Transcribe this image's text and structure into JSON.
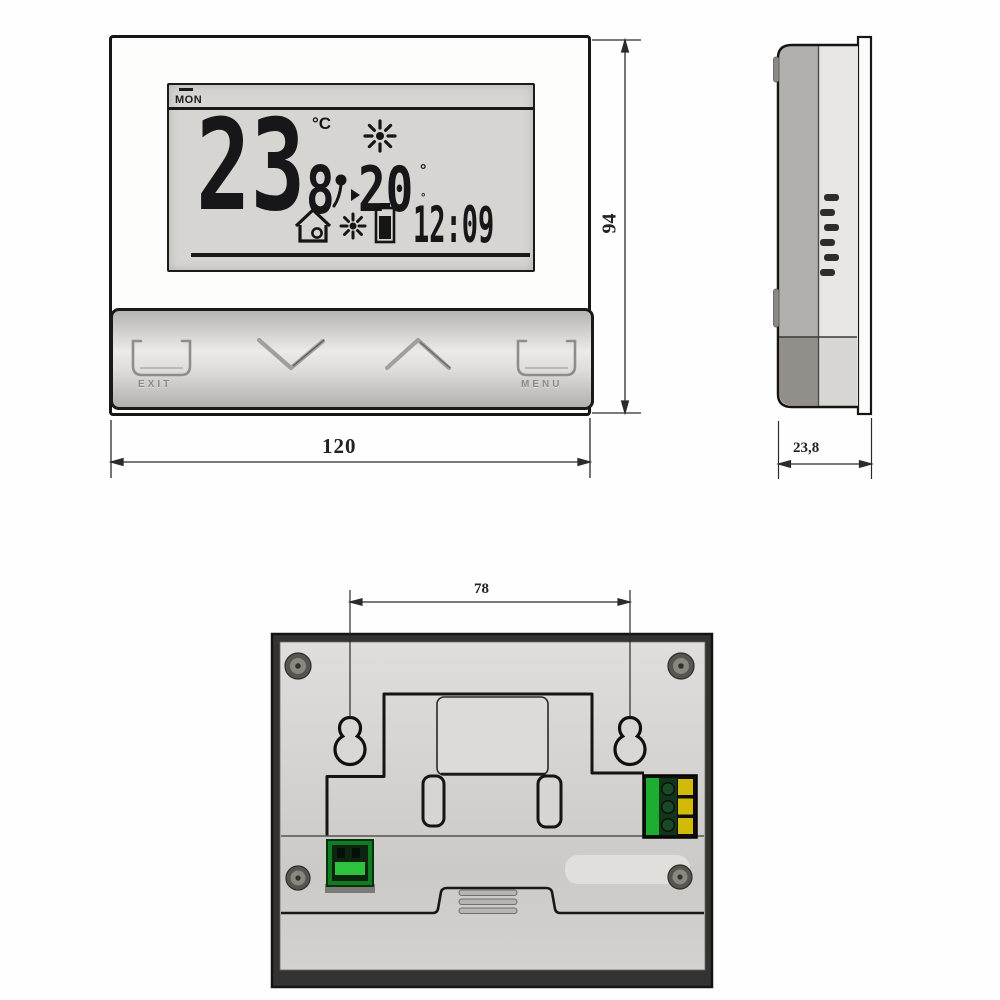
{
  "front": {
    "lcd": {
      "day": "MON",
      "temp": "23",
      "unit": "°C",
      "zone_digit": "8",
      "setpoint": "20",
      "deg_top": "°",
      "deg_bottom": "°",
      "time": "12:09"
    },
    "buttons": {
      "exit": "EXIT",
      "menu": "MENU"
    },
    "dim_width": "120",
    "dim_height": "94"
  },
  "side": {
    "dim_depth": "23,8"
  },
  "back": {
    "dim_hole_spacing": "78"
  },
  "colors": {
    "line": "#1a1a1a",
    "lcd_bg": "#d6d5d1",
    "connector_green": "#1cae31",
    "terminal_yellow": "#d2ba08"
  }
}
